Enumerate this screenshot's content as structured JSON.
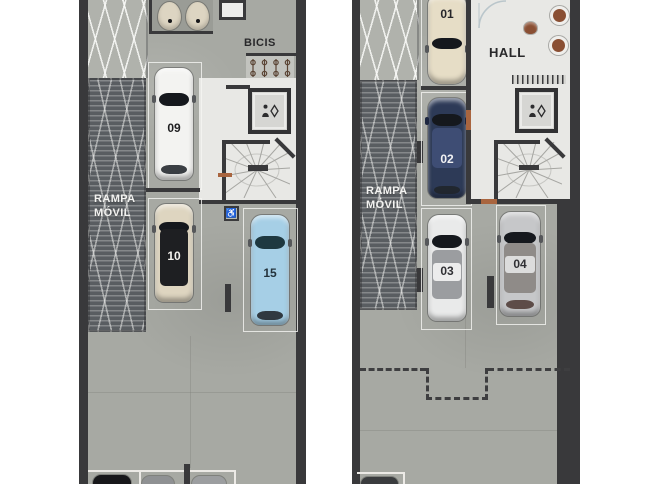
{
  "document": {
    "type": "parking-floor-plan",
    "background_color": "#ffffff"
  },
  "colors": {
    "concrete_floor": "#a7a9a3",
    "wall": "#39393b",
    "white_floor": "#e8e8e5",
    "ramp": "#595d61",
    "parking_outline": "#f0efec",
    "door_accent": "#a9653f",
    "dashed_line": "#3e3e40"
  },
  "icons": {
    "accessible_glyph": "♿"
  },
  "panels": {
    "left": {
      "ramp_label": "RAMPA\nMÓVIL",
      "bicis_label": "BICIS",
      "cars": [
        {
          "number": "09",
          "body_color": "#f3f3f1",
          "number_color": "#1e1e20"
        },
        {
          "number": "10",
          "body_color": "#ded5c0",
          "number_color": "#f4f2ee"
        },
        {
          "number": "15",
          "body_color": "#a6cfe6",
          "number_color": "#24333c"
        }
      ]
    },
    "right": {
      "ramp_label": "RAMPA\nMÓVIL",
      "hall_label": "HALL",
      "cars": [
        {
          "number": "01",
          "body_color": "#e6ddc6",
          "number_color": "#26262a"
        },
        {
          "number": "02",
          "body_color": "#2d3a57",
          "number_color": "#f2f2f4"
        },
        {
          "number": "03",
          "body_color": "#e9eaea",
          "number_color": "#303034"
        },
        {
          "number": "04",
          "body_color": "#c6c7c9",
          "number_color": "#303034"
        }
      ]
    }
  }
}
